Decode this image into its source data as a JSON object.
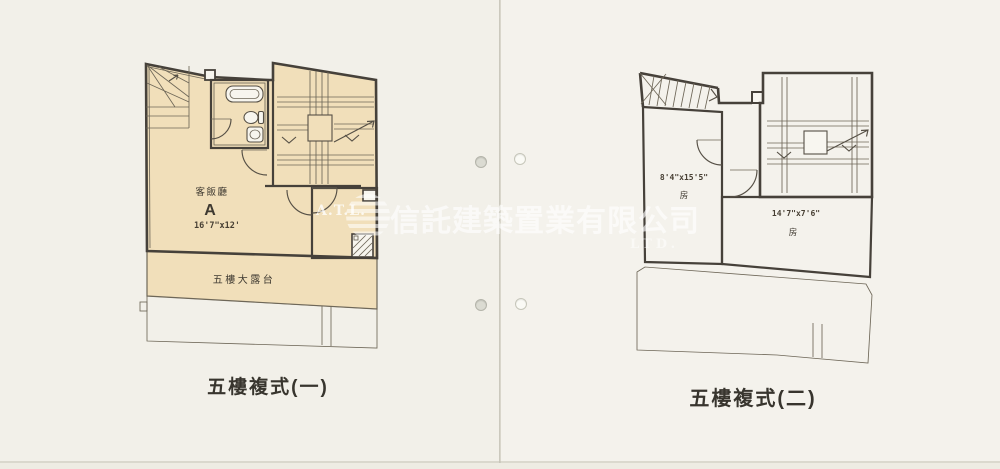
{
  "document": {
    "plans": [
      {
        "caption": "五樓複式(一)",
        "labels": {
          "room_name": "客飯廳",
          "unit": "A",
          "dimensions": "16'7\"x12'",
          "terrace": "五樓大露台"
        }
      },
      {
        "caption": "五樓複式(二)",
        "labels": {
          "room1_dimensions": "8'4\"x15'5\"",
          "room1_name": "房",
          "room2_dimensions": "14'7\"x7'6\"",
          "room2_name": "房"
        }
      }
    ],
    "watermark": {
      "logo_text": "A.T.L.",
      "company_text": "信託建築置業有限公司",
      "suffix_text": "LTD."
    },
    "colors": {
      "paper": "#f2f0e9",
      "floor_fill": "#f1dfba",
      "wall_line": "#46413a"
    }
  }
}
